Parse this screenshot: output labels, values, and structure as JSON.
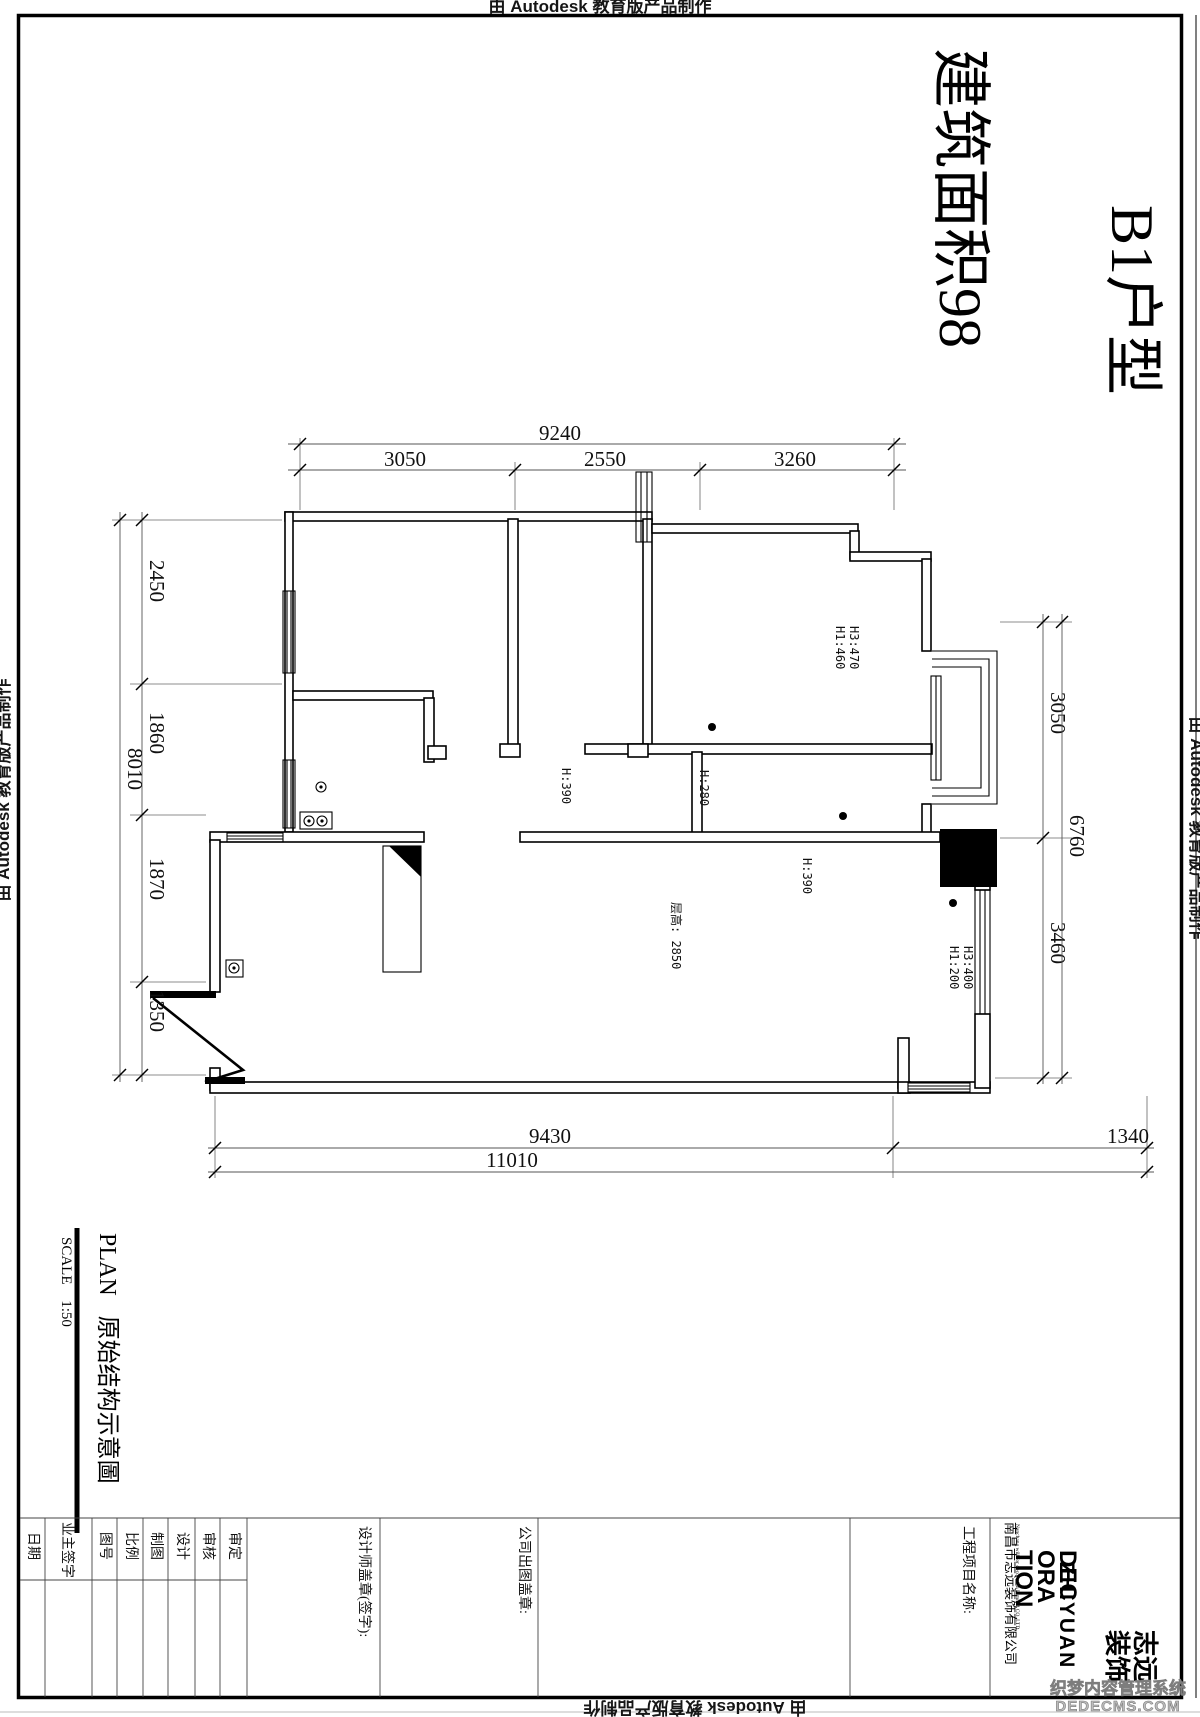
{
  "autodesk_credit": "由 Autodesk 教育版产品制作",
  "title": {
    "line1": "B1户型",
    "line2": "建筑面积98"
  },
  "plan_labels": {
    "floor_height": "层高: 2850",
    "h390_left": "H:390",
    "h280": "H:280",
    "h390_right": "H:390",
    "master_h1": "H1:460",
    "master_h3": "H3:470",
    "dining_h1": "H1:200",
    "dining_h3": "H3:400"
  },
  "dims": {
    "top": {
      "overall": "9240",
      "segments": [
        "3050",
        "2550",
        "3260"
      ]
    },
    "left": {
      "overall": "8010",
      "segments": [
        "2450",
        "1860",
        "1870",
        "1350"
      ]
    },
    "right": {
      "overall": "6760",
      "segments": [
        "3050",
        "3460"
      ]
    },
    "bottom": {
      "overall": "11010",
      "segments": [
        "9430",
        "1340"
      ]
    }
  },
  "drawing_title": {
    "type": "PLAN",
    "name": "原始结构示意圖",
    "scale_label": "SCALE",
    "scale_value": "1:50"
  },
  "title_block": {
    "fields": [
      "审定",
      "审核",
      "设计",
      "制图",
      "比例",
      "图号",
      "业主签字",
      "日期"
    ],
    "designer_stamp": "设计师盖章(签字):",
    "company_stamp": "公司出图盖章:",
    "project_name": "工程项目名称:",
    "company": {
      "name": "南昌市志远装饰有限公司",
      "name_en": "Nanchang will for decoration Limited CO.,LTD",
      "logo_lines": [
        "DEC",
        "ORA",
        "TION",
        "ZHIYUAN"
      ],
      "seal_line1": "志远",
      "seal_line2": "装饰"
    }
  },
  "watermark": {
    "line1": "织梦内容管理系统",
    "line2": "DEDECMS.COM"
  },
  "colors": {
    "ink": "#000000",
    "watermark": "#bdbdbd"
  }
}
